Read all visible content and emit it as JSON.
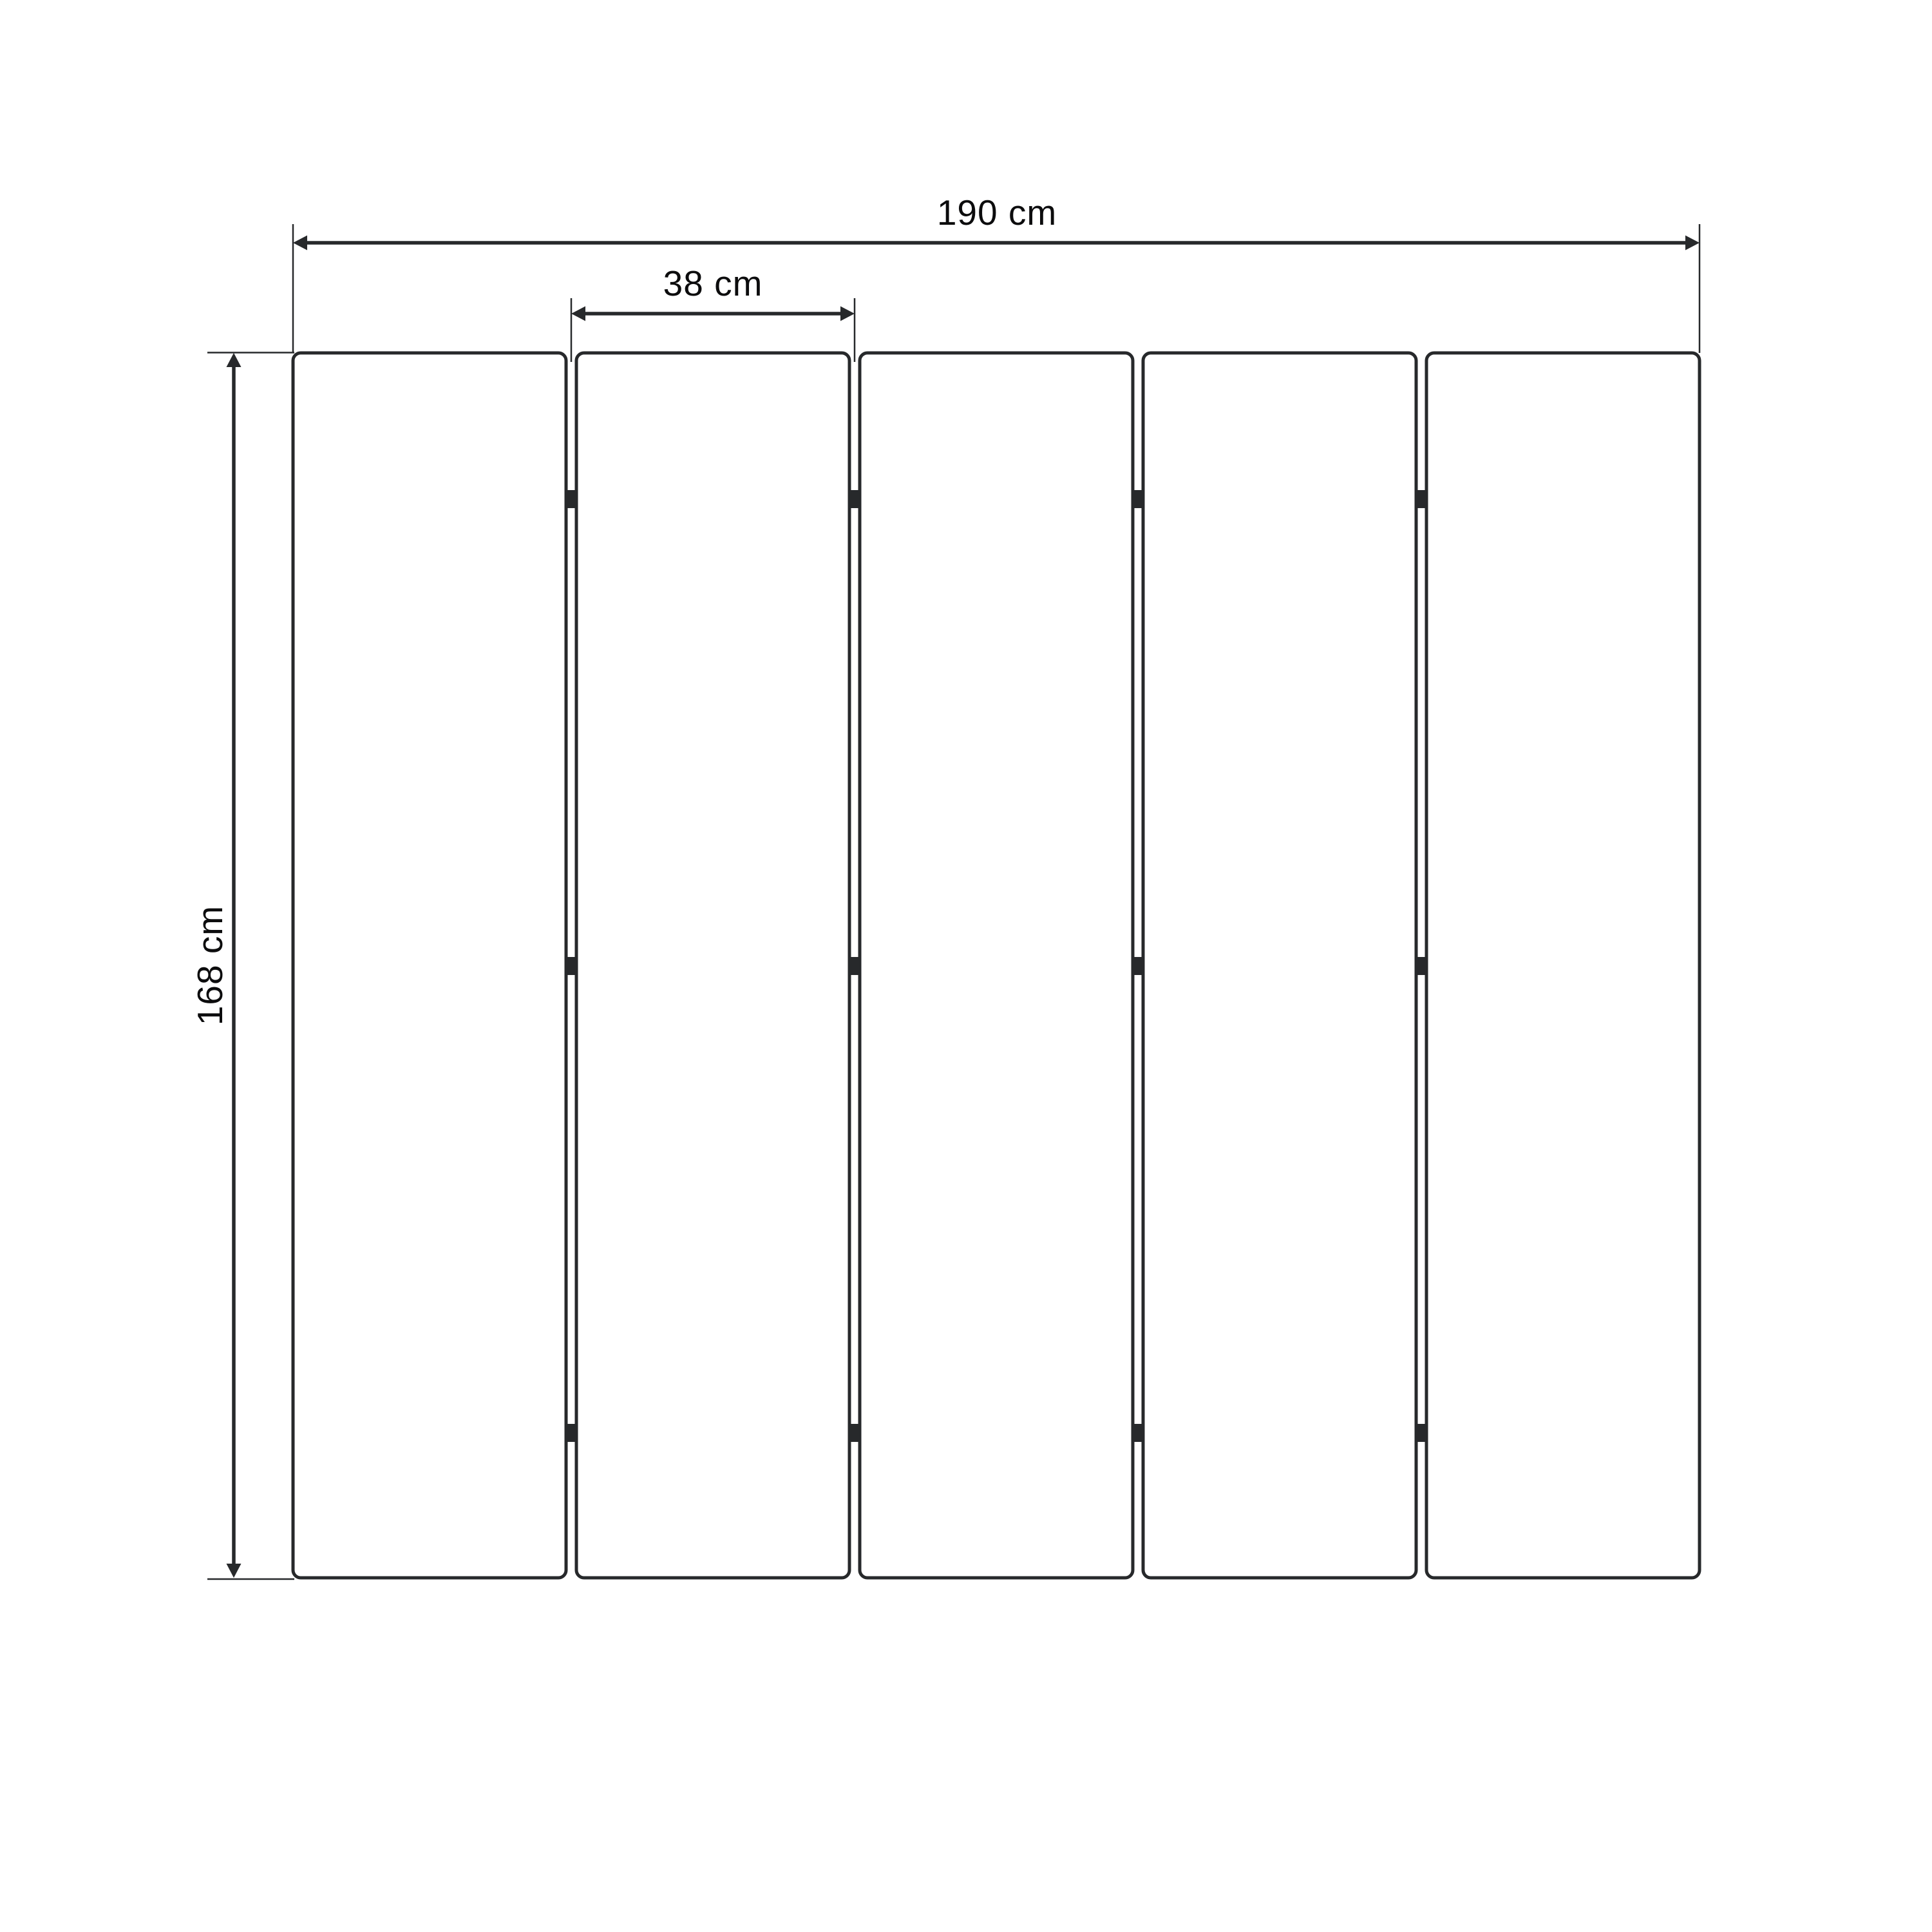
{
  "diagram": {
    "type": "technical-drawing",
    "panel_count": 5,
    "joint_count": 4,
    "hinges_per_joint": 3,
    "labels": {
      "total_width": "190 cm",
      "panel_width": "38 cm",
      "height": "168 cm"
    },
    "colors": {
      "line": "#27292b",
      "text": "#0c0c0d",
      "background": "#ffffff",
      "panel_fill": "#ffffff"
    }
  }
}
